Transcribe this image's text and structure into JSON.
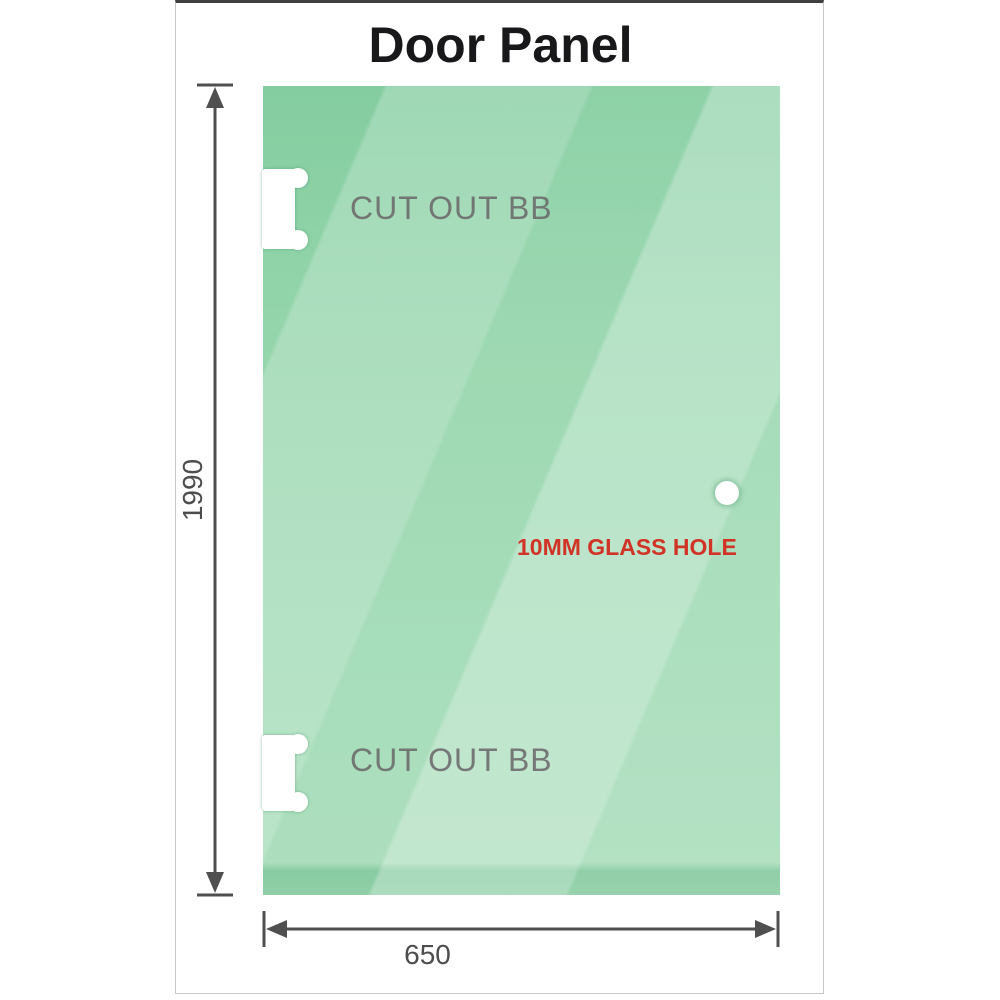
{
  "diagram": {
    "title": "Door Panel",
    "glass_panel": {
      "cutouts": [
        {
          "label": "CUT OUT BB",
          "position": "top-left-edge"
        },
        {
          "label": "CUT OUT BB",
          "position": "bottom-left-edge"
        }
      ],
      "glass_hole": {
        "label": "10MM GLASS HOLE"
      }
    },
    "dimensions": {
      "height": {
        "value": "1990",
        "orientation": "vertical"
      },
      "width": {
        "value": "650",
        "orientation": "horizontal"
      }
    },
    "colors": {
      "glass_green": "#93d4aa",
      "glass_highlight": "#c3e8d0",
      "glass_dark_band": "#7ec79a",
      "dimension_line": "#4f4f4f",
      "cutout_label": "#6d6d6d",
      "hole_label": "#d13427",
      "title": "#18181b",
      "frame_border": "#c6c6c6",
      "frame_top_bar": "#3f3f3f"
    }
  }
}
